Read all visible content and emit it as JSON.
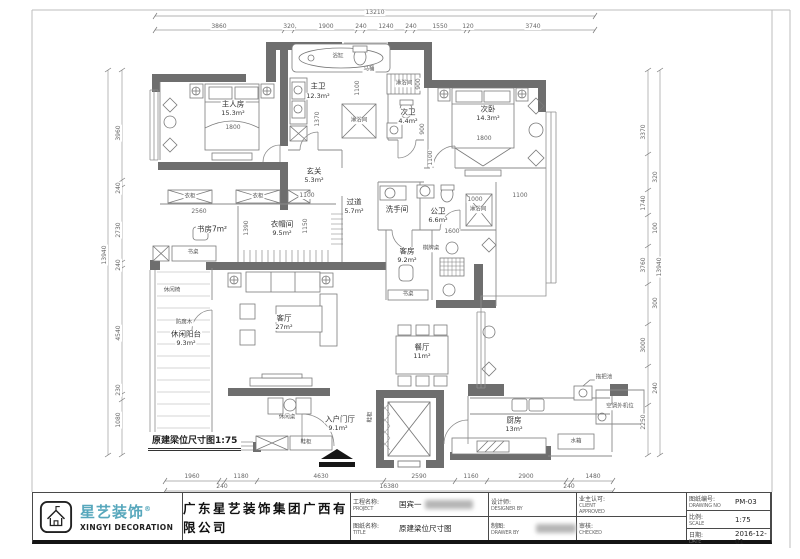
{
  "drawing_label": "原建梁位尺寸图1:75",
  "title_block": {
    "logo": {
      "brand_cn": "星艺装饰",
      "reg_mark": "®",
      "brand_en": "XINGYI DECORATION",
      "icon": "house-logo-icon",
      "accent_color": "#57a7bc"
    },
    "company": "广东星艺装饰集团广西有限公司",
    "fields": [
      {
        "label_cn": "工程名称:",
        "label_en": "PROJECT",
        "value": "国宾一",
        "blurred": true
      },
      {
        "label_cn": "图纸名称:",
        "label_en": "TITLE",
        "value": "原建梁位尺寸图",
        "blurred": false
      },
      {
        "label_cn": "设计师:",
        "label_en": "DESIGNER BY",
        "value": "",
        "blurred": false
      },
      {
        "label_cn": "制图:",
        "label_en": "DRAWER BY",
        "value": "",
        "blurred": true
      },
      {
        "label_cn": "业主认可:",
        "label_en": "CLIENT APPROVED",
        "value": "",
        "blurred": false
      },
      {
        "label_cn": "审核:",
        "label_en": "CHECKED",
        "value": "",
        "blurred": false
      },
      {
        "label_cn": "图纸编号:",
        "label_en": "DRAWING NO",
        "value": "PM-03",
        "blurred": false
      },
      {
        "label_cn": "比例:",
        "label_en": "SCALE",
        "value": "1:75",
        "blurred": false
      },
      {
        "label_cn": "日期:",
        "label_en": "DATE",
        "value": "2016-12-01",
        "blurred": false
      }
    ]
  },
  "plan": {
    "scale": "1:75",
    "rooms_summary": [
      {
        "name": "主人房",
        "area": "15.3m²"
      },
      {
        "name": "主卫",
        "area": "12.3m²"
      },
      {
        "name": "次卫",
        "area": "4.4m²"
      },
      {
        "name": "次卧",
        "area": "14.3m²"
      },
      {
        "name": "玄关",
        "area": "5.3m²"
      },
      {
        "name": "过道",
        "area": "5.7m²"
      },
      {
        "name": "书房",
        "area": "7m²"
      },
      {
        "name": "衣帽间",
        "area": "9.5m²"
      },
      {
        "name": "洗手间",
        "area": ""
      },
      {
        "name": "公卫",
        "area": "6.6m²"
      },
      {
        "name": "客房",
        "area": "9.2m²"
      },
      {
        "name": "客厅",
        "area": "27m²"
      },
      {
        "name": "休闲阳台",
        "area": "9.3m²"
      },
      {
        "name": "餐厅",
        "area": "11m²"
      },
      {
        "name": "入户门厅",
        "area": "9.1m²"
      },
      {
        "name": "厨房",
        "area": "13m²"
      }
    ],
    "labels": [
      {
        "t": "主人房",
        "x": 233,
        "y": 104,
        "c": "room"
      },
      {
        "t": "15.3m²",
        "x": 233,
        "y": 113,
        "c": "area"
      },
      {
        "t": "主卫",
        "x": 318,
        "y": 86,
        "c": "room"
      },
      {
        "t": "12.3m²",
        "x": 318,
        "y": 96,
        "c": "area"
      },
      {
        "t": "次卫",
        "x": 408,
        "y": 112,
        "c": "room"
      },
      {
        "t": "4.4m²",
        "x": 408,
        "y": 121,
        "c": "area"
      },
      {
        "t": "次卧",
        "x": 488,
        "y": 109,
        "c": "room"
      },
      {
        "t": "14.3m²",
        "x": 488,
        "y": 118,
        "c": "area"
      },
      {
        "t": "玄关",
        "x": 314,
        "y": 171,
        "c": "room"
      },
      {
        "t": "5.3m²",
        "x": 314,
        "y": 180,
        "c": "area"
      },
      {
        "t": "过道",
        "x": 354,
        "y": 202,
        "c": "room"
      },
      {
        "t": "5.7m²",
        "x": 354,
        "y": 211,
        "c": "area"
      },
      {
        "t": "书房7m²",
        "x": 212,
        "y": 229,
        "c": "room"
      },
      {
        "t": "衣帽间",
        "x": 282,
        "y": 224,
        "c": "room"
      },
      {
        "t": "9.5m²",
        "x": 282,
        "y": 233,
        "c": "area"
      },
      {
        "t": "洗手间",
        "x": 397,
        "y": 209,
        "c": "room"
      },
      {
        "t": "公卫",
        "x": 438,
        "y": 211,
        "c": "room"
      },
      {
        "t": "6.6m²",
        "x": 438,
        "y": 220,
        "c": "area"
      },
      {
        "t": "客房",
        "x": 407,
        "y": 251,
        "c": "room"
      },
      {
        "t": "9.2m²",
        "x": 407,
        "y": 260,
        "c": "area"
      },
      {
        "t": "客厅",
        "x": 284,
        "y": 318,
        "c": "room"
      },
      {
        "t": "27m²",
        "x": 284,
        "y": 327,
        "c": "area"
      },
      {
        "t": "休闲阳台",
        "x": 186,
        "y": 334,
        "c": "room"
      },
      {
        "t": "9.3m²",
        "x": 186,
        "y": 343,
        "c": "area"
      },
      {
        "t": "餐厅",
        "x": 422,
        "y": 347,
        "c": "room"
      },
      {
        "t": "11m²",
        "x": 422,
        "y": 356,
        "c": "area"
      },
      {
        "t": "入户门厅",
        "x": 340,
        "y": 419,
        "c": "room"
      },
      {
        "t": "9.1m²",
        "x": 338,
        "y": 428,
        "c": "area"
      },
      {
        "t": "厨房",
        "x": 514,
        "y": 420,
        "c": "room"
      },
      {
        "t": "13m²",
        "x": 514,
        "y": 429,
        "c": "area"
      },
      {
        "t": "马桶",
        "x": 369,
        "y": 70,
        "c": "furn"
      },
      {
        "t": "浴缸",
        "x": 338,
        "y": 57,
        "c": "furn"
      },
      {
        "t": "淋浴间",
        "x": 404,
        "y": 84,
        "c": "furn"
      },
      {
        "t": "淋浴间",
        "x": 359,
        "y": 121,
        "c": "furn"
      },
      {
        "t": "淋浴间",
        "x": 478,
        "y": 210,
        "c": "furn"
      },
      {
        "t": "衣柜",
        "x": 190,
        "y": 197,
        "c": "furn"
      },
      {
        "t": "衣柜",
        "x": 258,
        "y": 197,
        "c": "furn"
      },
      {
        "t": "书桌",
        "x": 193,
        "y": 253,
        "c": "furn"
      },
      {
        "t": "书桌",
        "x": 408,
        "y": 295,
        "c": "furn"
      },
      {
        "t": "棋牌桌",
        "x": 431,
        "y": 249,
        "c": "furn"
      },
      {
        "t": "休闲椅",
        "x": 172,
        "y": 291,
        "c": "furn"
      },
      {
        "t": "防腐木",
        "x": 184,
        "y": 323,
        "c": "furn"
      },
      {
        "t": "休闲桌",
        "x": 287,
        "y": 418,
        "c": "furn"
      },
      {
        "t": "鞋柜",
        "x": 306,
        "y": 443,
        "c": "furn"
      },
      {
        "t": "鞋柜",
        "x": 371,
        "y": 417,
        "r": -90,
        "c": "furn"
      },
      {
        "t": "空调外机位",
        "x": 620,
        "y": 407,
        "c": "furn"
      },
      {
        "t": "水箱",
        "x": 576,
        "y": 442,
        "c": "furn"
      },
      {
        "t": "拖把池",
        "x": 604,
        "y": 378,
        "c": "furn"
      },
      {
        "t": "13210",
        "x": 375,
        "y": 13,
        "c": "tot"
      },
      {
        "t": "3860",
        "x": 219,
        "y": 27,
        "c": "dim"
      },
      {
        "t": "320",
        "x": 289,
        "y": 27,
        "c": "dim"
      },
      {
        "t": "1900",
        "x": 326,
        "y": 27,
        "c": "dim"
      },
      {
        "t": "240",
        "x": 361,
        "y": 27,
        "c": "dim"
      },
      {
        "t": "1240",
        "x": 386,
        "y": 27,
        "c": "dim"
      },
      {
        "t": "240",
        "x": 411,
        "y": 27,
        "c": "dim"
      },
      {
        "t": "1550",
        "x": 440,
        "y": 27,
        "c": "dim"
      },
      {
        "t": "120",
        "x": 468,
        "y": 27,
        "c": "dim"
      },
      {
        "t": "3740",
        "x": 533,
        "y": 27,
        "c": "dim"
      },
      {
        "t": "1960",
        "x": 192,
        "y": 477,
        "c": "dim"
      },
      {
        "t": "1180",
        "x": 241,
        "y": 477,
        "c": "dim"
      },
      {
        "t": "4630",
        "x": 321,
        "y": 477,
        "c": "dim"
      },
      {
        "t": "2590",
        "x": 419,
        "y": 477,
        "c": "dim"
      },
      {
        "t": "1160",
        "x": 471,
        "y": 477,
        "c": "dim"
      },
      {
        "t": "2900",
        "x": 526,
        "y": 477,
        "c": "dim"
      },
      {
        "t": "1480",
        "x": 593,
        "y": 477,
        "c": "dim"
      },
      {
        "t": "240",
        "x": 222,
        "y": 487,
        "c": "dim"
      },
      {
        "t": "16380",
        "x": 389,
        "y": 487,
        "c": "tot"
      },
      {
        "t": "240",
        "x": 569,
        "y": 487,
        "c": "dim"
      },
      {
        "t": "3960",
        "x": 119,
        "y": 133,
        "r": -90,
        "c": "dim"
      },
      {
        "t": "240",
        "x": 119,
        "y": 188,
        "r": -90,
        "c": "dim"
      },
      {
        "t": "2730",
        "x": 119,
        "y": 230,
        "r": -90,
        "c": "dim"
      },
      {
        "t": "240",
        "x": 119,
        "y": 265,
        "r": -90,
        "c": "dim"
      },
      {
        "t": "4540",
        "x": 119,
        "y": 333,
        "r": -90,
        "c": "dim"
      },
      {
        "t": "230",
        "x": 119,
        "y": 390,
        "r": -90,
        "c": "dim"
      },
      {
        "t": "1080",
        "x": 119,
        "y": 420,
        "r": -90,
        "c": "dim"
      },
      {
        "t": "13940",
        "x": 105,
        "y": 255,
        "r": -90,
        "c": "tot"
      },
      {
        "t": "3370",
        "x": 644,
        "y": 132,
        "r": -90,
        "c": "dim"
      },
      {
        "t": "1740",
        "x": 644,
        "y": 203,
        "r": -90,
        "c": "dim"
      },
      {
        "t": "3760",
        "x": 644,
        "y": 265,
        "r": -90,
        "c": "dim"
      },
      {
        "t": "3000",
        "x": 644,
        "y": 345,
        "r": -90,
        "c": "dim"
      },
      {
        "t": "2250",
        "x": 644,
        "y": 422,
        "r": -90,
        "c": "dim"
      },
      {
        "t": "320",
        "x": 656,
        "y": 177,
        "r": -90,
        "c": "dim"
      },
      {
        "t": "100",
        "x": 656,
        "y": 228,
        "r": -90,
        "c": "dim"
      },
      {
        "t": "300",
        "x": 656,
        "y": 303,
        "r": -90,
        "c": "dim"
      },
      {
        "t": "240",
        "x": 656,
        "y": 388,
        "r": -90,
        "c": "dim"
      },
      {
        "t": "13940",
        "x": 660,
        "y": 267,
        "r": -90,
        "c": "tot"
      },
      {
        "t": "1800",
        "x": 233,
        "y": 128,
        "c": "dim"
      },
      {
        "t": "1800",
        "x": 484,
        "y": 139,
        "c": "dim"
      },
      {
        "t": "2560",
        "x": 199,
        "y": 212,
        "c": "dim"
      },
      {
        "t": "1600",
        "x": 452,
        "y": 232,
        "c": "dim"
      },
      {
        "t": "1000",
        "x": 475,
        "y": 200,
        "c": "dim"
      },
      {
        "t": "1100",
        "x": 307,
        "y": 196,
        "c": "dim"
      },
      {
        "t": "1100",
        "x": 520,
        "y": 196,
        "c": "dim"
      },
      {
        "t": "1100",
        "x": 358,
        "y": 88,
        "r": -90,
        "c": "dim"
      },
      {
        "t": "1100",
        "x": 431,
        "y": 158,
        "r": -90,
        "c": "dim"
      },
      {
        "t": "1370",
        "x": 318,
        "y": 119,
        "r": -90,
        "c": "dim"
      },
      {
        "t": "900",
        "x": 419,
        "y": 84,
        "r": -90,
        "c": "dim"
      },
      {
        "t": "900",
        "x": 423,
        "y": 129,
        "r": -90,
        "c": "dim"
      },
      {
        "t": "1390",
        "x": 247,
        "y": 228,
        "r": -90,
        "c": "dim"
      },
      {
        "t": "1150",
        "x": 306,
        "y": 226,
        "r": -90,
        "c": "dim"
      }
    ],
    "chains": [
      {
        "o": "h",
        "p": 16,
        "a": 155,
        "b": 595,
        "t": [
          155,
          595
        ]
      },
      {
        "o": "h",
        "p": 30,
        "a": 155,
        "b": 595,
        "t": [
          155,
          284,
          294,
          357,
          365,
          407,
          415,
          466,
          470,
          595
        ]
      },
      {
        "o": "h",
        "p": 481,
        "a": 165,
        "b": 613,
        "t": [
          165,
          219,
          225,
          257,
          384,
          455,
          487,
          566,
          572,
          613
        ]
      },
      {
        "o": "h",
        "p": 491,
        "a": 165,
        "b": 613,
        "t": [
          165,
          613
        ]
      },
      {
        "o": "v",
        "p": 122,
        "a": 70,
        "b": 455,
        "t": [
          70,
          180,
          187,
          262,
          268,
          394,
          400,
          455
        ]
      },
      {
        "o": "v",
        "p": 108,
        "a": 70,
        "b": 455,
        "t": [
          70,
          455
        ]
      },
      {
        "o": "v",
        "p": 648,
        "a": 70,
        "b": 455,
        "t": [
          70,
          154,
          190,
          215,
          246,
          284,
          324,
          366,
          405,
          455
        ]
      },
      {
        "o": "v",
        "p": 660,
        "a": 70,
        "b": 455,
        "t": [
          70,
          455
        ]
      }
    ]
  }
}
